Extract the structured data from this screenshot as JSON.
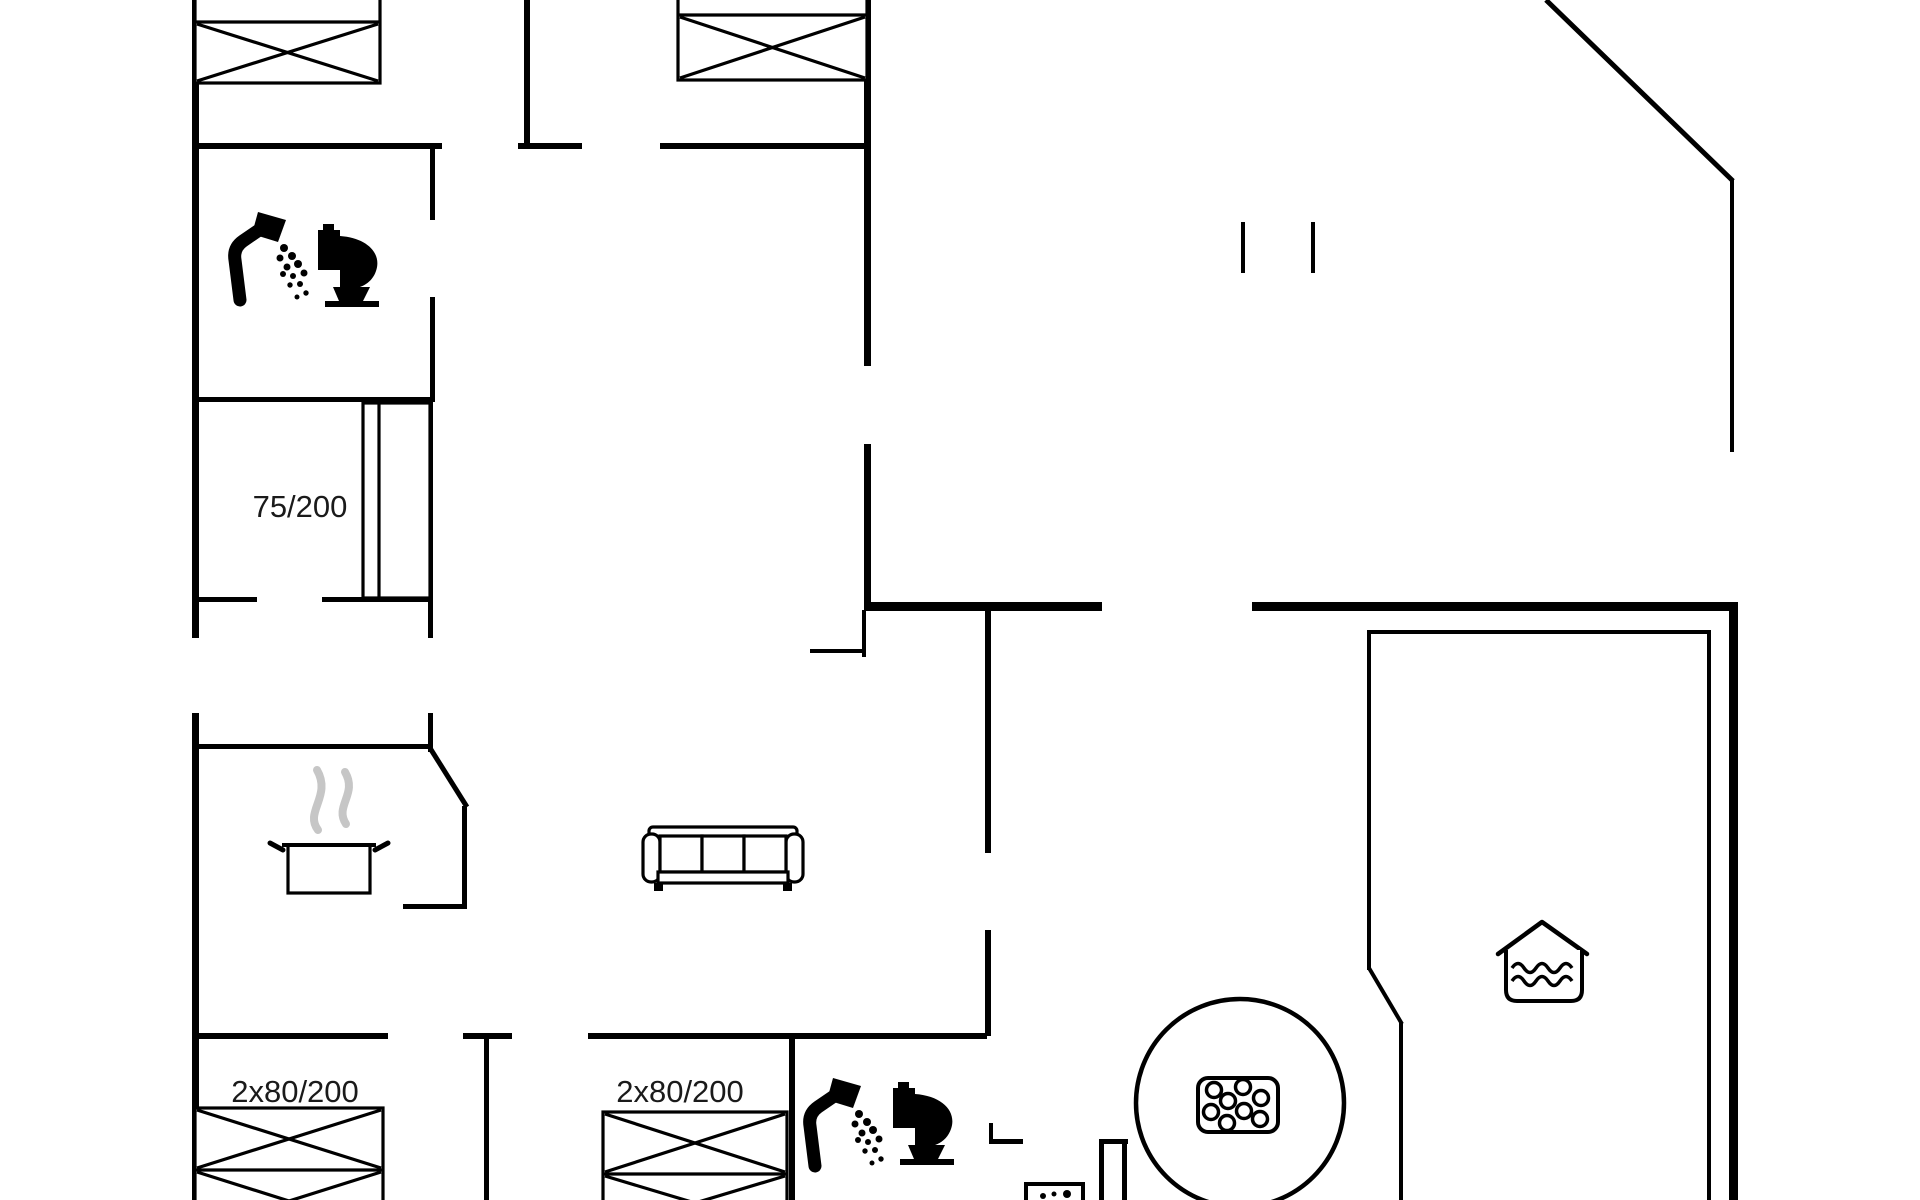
{
  "document": {
    "type": "holiday-house-floor-plan",
    "background": "#ffffff"
  },
  "colors": {
    "wall": "#000000",
    "furniture_line": "#000000",
    "steam": "#c6c6c6",
    "text": "#1a1a1a"
  },
  "labels": {
    "single_bed_size": "75/200",
    "double_bed_size_left": "2x80/200",
    "double_bed_size_right": "2x80/200"
  },
  "icons": [
    {
      "name": "double-bed-icon",
      "location": "top-left bedroom"
    },
    {
      "name": "double-bed-icon",
      "location": "top-center bedroom"
    },
    {
      "name": "shower-icon",
      "location": "upper bathroom"
    },
    {
      "name": "toilet-icon",
      "location": "upper bathroom"
    },
    {
      "name": "single-bed-icon",
      "location": "small bedroom"
    },
    {
      "name": "cooking-pot-icon",
      "location": "kitchen"
    },
    {
      "name": "steam-icon",
      "location": "kitchen"
    },
    {
      "name": "sofa-icon",
      "location": "living room"
    },
    {
      "name": "double-bed-icon",
      "location": "bottom-left bedroom"
    },
    {
      "name": "double-bed-icon",
      "location": "bottom-center bedroom"
    },
    {
      "name": "shower-icon",
      "location": "lower bathroom"
    },
    {
      "name": "toilet-icon",
      "location": "lower bathroom"
    },
    {
      "name": "washing-machine-icon",
      "location": "utility niche"
    },
    {
      "name": "hot-tub-icon",
      "location": "wellness area"
    },
    {
      "name": "bubble-jets-icon",
      "location": "inside hot tub"
    },
    {
      "name": "sauna-icon",
      "location": "sauna room"
    },
    {
      "name": "door-opening-ticks",
      "location": "upper right open area"
    }
  ]
}
